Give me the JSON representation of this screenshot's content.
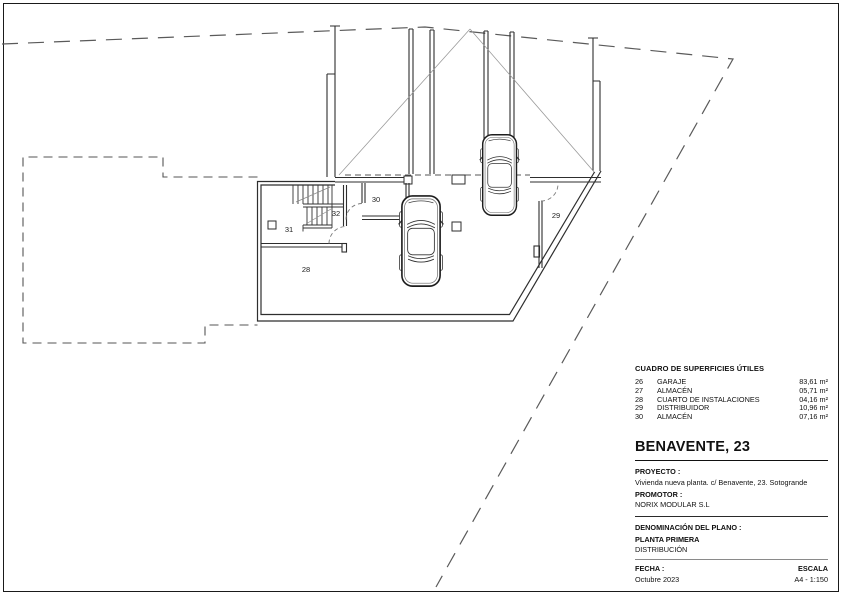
{
  "plan": {
    "room_labels": {
      "r28": "28",
      "r29": "29",
      "r30": "30",
      "r31": "31",
      "r32": "32"
    }
  },
  "surface_table": {
    "title": "CUADRO DE SUPERFICIES ÚTILES",
    "rows": [
      {
        "num": "26",
        "name": "GARAJE",
        "area": "83,61 m²"
      },
      {
        "num": "27",
        "name": "ALMACÉN",
        "area": "05,71 m²"
      },
      {
        "num": "28",
        "name": "CUARTO DE INSTALACIONES",
        "area": "04,16 m²"
      },
      {
        "num": "29",
        "name": "DISTRIBUIDOR",
        "area": "10,96 m²"
      },
      {
        "num": "30",
        "name": "ALMACÉN",
        "area": "07,16 m²"
      }
    ]
  },
  "title_block": {
    "title": "BENAVENTE, 23",
    "project_label": "PROYECTO :",
    "project_value": "Vivienda nueva planta. c/ Benavente, 23. Sotogrande",
    "promoter_label": "PROMOTOR :",
    "promoter_value": "NORIX MODULAR S.L",
    "plan_name_label": "DENOMINACIÓN DEL PLANO :",
    "plan_name_line1": "PLANTA PRIMERA",
    "plan_name_line2": "DISTRIBUCIÓN",
    "date_label": "FECHA :",
    "date_value": "Octubre 2023",
    "scale_label": "ESCALA",
    "scale_value": "A4 - 1:150"
  },
  "colors": {
    "ink": "#2e2e2e",
    "boundary": "#5a5a5a",
    "accent": "#111111"
  }
}
